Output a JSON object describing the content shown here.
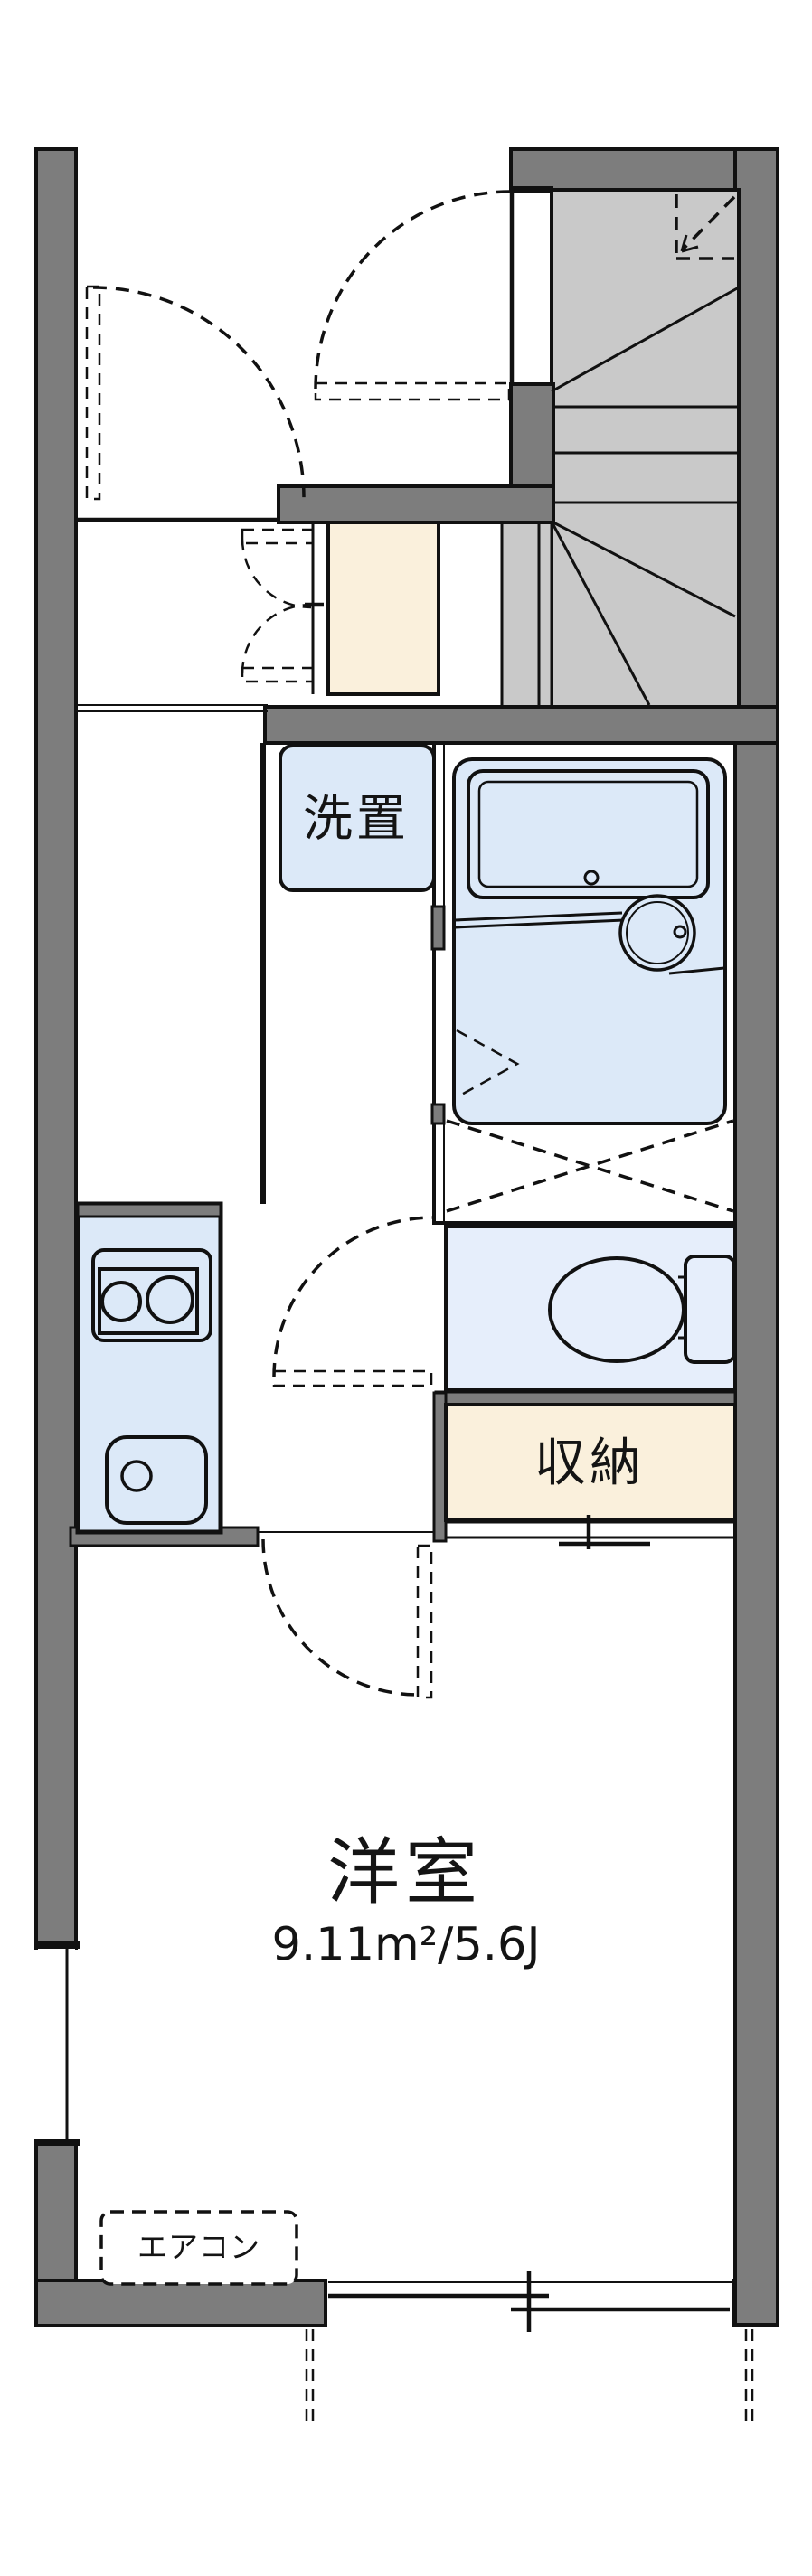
{
  "plan": {
    "type": "japanese-apartment-floorplan",
    "rooms": {
      "western_room": {
        "label": "洋室",
        "area_label": "9.11m²/5.6J"
      },
      "washer_place": {
        "label": "洗置"
      },
      "storage": {
        "label": "収納"
      },
      "aircon": {
        "label": "エアコン"
      }
    },
    "colors": {
      "wall": "#7d7d7d",
      "stair": "#c9c9c9",
      "fixture": "#dce9f8",
      "fixlight": "#e6eefb",
      "storage": "#faf0dc",
      "line": "#111111",
      "background": "#ffffff"
    }
  }
}
